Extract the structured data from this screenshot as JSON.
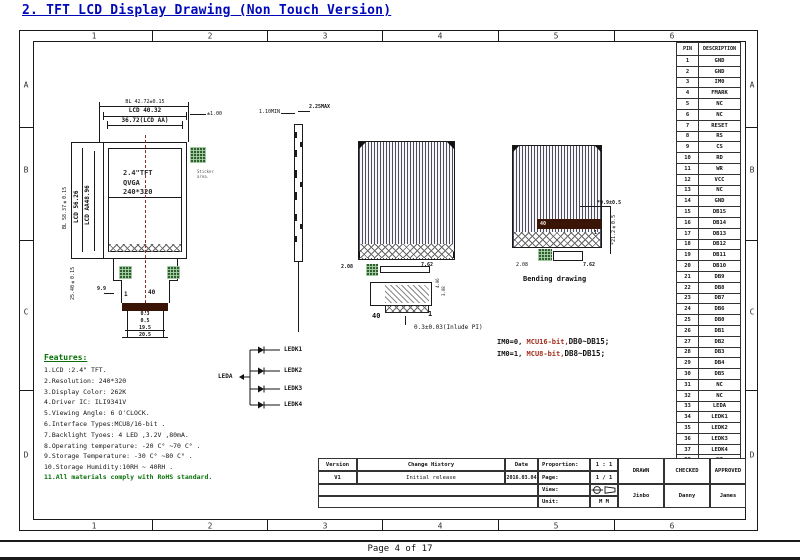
{
  "page": {
    "title": "2. TFT LCD Display Drawing (Non Touch Version)",
    "footer": "Page 4 of 17"
  },
  "frame": {
    "top_zones": [
      "1",
      "2",
      "3",
      "4",
      "5",
      "6"
    ],
    "bottom_zones": [
      "1",
      "2",
      "3",
      "4",
      "5",
      "6"
    ],
    "left_zones": [
      "A",
      "B",
      "C",
      "D"
    ],
    "right_zones": [
      "A",
      "B",
      "C",
      "D"
    ]
  },
  "front_view": {
    "dim_bl_w": "BL 42.72±0.15",
    "dim_lcd_w": "LCD 40.32",
    "dim_aa_w": "36.72(LCD AA)",
    "dim_right": "±1.00",
    "dim_bl_h": "BL 58.37±0.15",
    "dim_lcd_h": "LCD 56.26",
    "dim_aa_h": "LCD AA48.96",
    "dim_fpc_h": "25.40±0.15",
    "label_lines": [
      "2.4\"TFT",
      "QVGA",
      "240*320"
    ],
    "sticker_note": [
      "Sticker",
      "area."
    ],
    "dim_tail": "9.9",
    "pin_first": "1",
    "pin_last": "40",
    "dims_bottom": [
      "0.3",
      "0.5",
      "19.5",
      "20.5"
    ]
  },
  "side_view": {
    "dim_min": "1.10MIN",
    "dim_max": "2.25MAX"
  },
  "back_view": {
    "dim_left": "2.08",
    "dim_right": "7.62",
    "pin_last": "40",
    "pin_first": "1",
    "dim_v1": "4.06",
    "dim_v2": "3.08",
    "note": "0.3±0.03(Inlude PI)"
  },
  "bending_view": {
    "caption": "Bending drawing",
    "dim_top": "*9.9±0.5",
    "dim_side": "*21.2±0.5",
    "dim_bottom_l": "2.08",
    "dim_bottom_r": "7.62",
    "bar_left": "40",
    "bar_right": "1"
  },
  "im0_notes": [
    {
      "prefix": "IM0=0, ",
      "mcu": "MCU16-bit,",
      "db": "DB0~DB15;"
    },
    {
      "prefix": "IM0=1, ",
      "mcu": "MCU8-bit,",
      "db": "DB8~DB15;"
    }
  ],
  "led_circuit": {
    "anode": "LEDA",
    "cathodes": [
      "LEDK1",
      "LEDK2",
      "LEDK3",
      "LEDK4"
    ]
  },
  "features": {
    "heading": "Features:",
    "items": [
      "1.LCD :2.4\" TFT.",
      "2.Resolution: 240*320",
      "3.Display Color: 262K",
      "4.Driver IC: ILI9341V",
      "5.Viewing Angle: 6 O'CLOCK.",
      "6.Interface Types:MCU8/16-bit .",
      "7.Backlight Tyoes: 4 LED ,3.2V ,80mA.",
      "8.Operating temperature: -20 C° ~70 C° .",
      "9.Storage Temperature: -30 C° ~80 C° .",
      "10.Storage Humidity:10RH ~ 40RH ."
    ],
    "rohs": "11.All materials comply with RoHS standard."
  },
  "pin_table": {
    "headers": [
      "PIN",
      "DESCRIPTION"
    ],
    "rows": [
      [
        "1",
        "GND"
      ],
      [
        "2",
        "GND"
      ],
      [
        "3",
        "IM0"
      ],
      [
        "4",
        "FMARK"
      ],
      [
        "5",
        "NC"
      ],
      [
        "6",
        "NC"
      ],
      [
        "7",
        "RESET"
      ],
      [
        "8",
        "RS"
      ],
      [
        "9",
        "CS"
      ],
      [
        "10",
        "RD"
      ],
      [
        "11",
        "WR"
      ],
      [
        "12",
        "VCC"
      ],
      [
        "13",
        "NC"
      ],
      [
        "14",
        "GND"
      ],
      [
        "15",
        "DB15"
      ],
      [
        "16",
        "DB14"
      ],
      [
        "17",
        "DB13"
      ],
      [
        "18",
        "DB12"
      ],
      [
        "19",
        "DB11"
      ],
      [
        "20",
        "DB10"
      ],
      [
        "21",
        "DB9"
      ],
      [
        "22",
        "DB8"
      ],
      [
        "23",
        "DB7"
      ],
      [
        "24",
        "DB6"
      ],
      [
        "25",
        "DB0"
      ],
      [
        "26",
        "DB1"
      ],
      [
        "27",
        "DB2"
      ],
      [
        "28",
        "DB3"
      ],
      [
        "29",
        "DB4"
      ],
      [
        "30",
        "DB5"
      ],
      [
        "31",
        "NC"
      ],
      [
        "32",
        "NC"
      ],
      [
        "33",
        "LEDA"
      ],
      [
        "34",
        "LEDK1"
      ],
      [
        "35",
        "LEDK2"
      ],
      [
        "36",
        "LEDK3"
      ],
      [
        "37",
        "LEDK4"
      ],
      [
        "38",
        "NC"
      ],
      [
        "39",
        "NC"
      ],
      [
        "40",
        "GND"
      ]
    ]
  },
  "title_block": {
    "version_label": "Version",
    "version": "V1",
    "history_label": "Change History",
    "history": "Initial release",
    "date_label": "Date",
    "date": "2016.03.04",
    "proportion_label": "Proportion:",
    "proportion": "1 : 1",
    "page_label": "Page:",
    "page": "1 / 1",
    "view_label": "View:",
    "unit_label": "Unit:",
    "unit": "M M",
    "drawn_label": "DRAWN",
    "drawn": "Jinbo",
    "checked_label": "CHECKED",
    "checked": "Danny",
    "approved_label": "APPROVED",
    "approved": "James"
  },
  "colors": {
    "title_blue": "#0009b8",
    "feature_green": "#067006",
    "mcu_red": "#a33020"
  }
}
